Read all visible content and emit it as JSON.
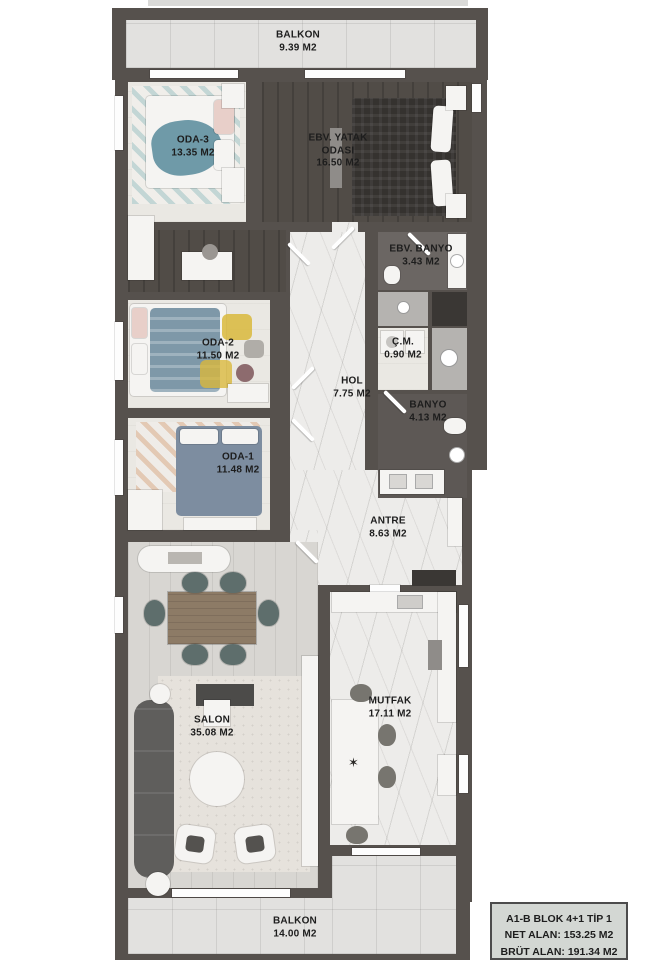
{
  "plan_title": "A1-B BLOK 4+1 TİP 1",
  "rooms": [
    {
      "id": "balkon-top",
      "name": "BALKON",
      "area": "9.39 M2"
    },
    {
      "id": "oda-3",
      "name": "ODA-3",
      "area": "13.35 M2"
    },
    {
      "id": "ebv-yatak",
      "name": "EBV. YATAK ODASI",
      "area": "16.50 M2"
    },
    {
      "id": "ebv-banyo",
      "name": "EBV. BANYO",
      "area": "3.43 M2"
    },
    {
      "id": "oda-2",
      "name": "ODA-2",
      "area": "11.50 M2"
    },
    {
      "id": "cm",
      "name": "Ç.M.",
      "area": "0.90 M2"
    },
    {
      "id": "hol",
      "name": "HOL",
      "area": "7.75 M2"
    },
    {
      "id": "banyo",
      "name": "BANYO",
      "area": "4.13 M2"
    },
    {
      "id": "oda-1",
      "name": "ODA-1",
      "area": "11.48 M2"
    },
    {
      "id": "antre",
      "name": "ANTRE",
      "area": "8.63 M2"
    },
    {
      "id": "salon",
      "name": "SALON",
      "area": "35.08 M2"
    },
    {
      "id": "mutfak",
      "name": "MUTFAK",
      "area": "17.11 M2"
    },
    {
      "id": "balkon-bottom",
      "name": "BALKON",
      "area": "14.00 M2"
    }
  ],
  "info_box": {
    "line1": "A1-B BLOK 4+1 TİP 1",
    "line2": "NET ALAN: 153.25 M2",
    "line3": "BRÜT ALAN: 191.34 M2"
  },
  "decor": {
    "kitchen_star": "✶"
  },
  "colors": {
    "wall": "#56514d",
    "floor_light": "#eae8e3",
    "floor_wood_dark": "#514c47",
    "marble": "#edecea",
    "tile": "#e2e1df",
    "salon_wood": "#d8d6d2",
    "bath_dark": "#5d5855",
    "accent_teal": "#6f9aa8",
    "accent_blue": "#7e98a8",
    "accent_mustard": "#d9b83c",
    "table_wood": "#8d7b66",
    "chair": "#5e6e6c",
    "info_bg": "#d3d7d3",
    "text": "#1d1d1d",
    "flower_red": "#8e3038"
  }
}
